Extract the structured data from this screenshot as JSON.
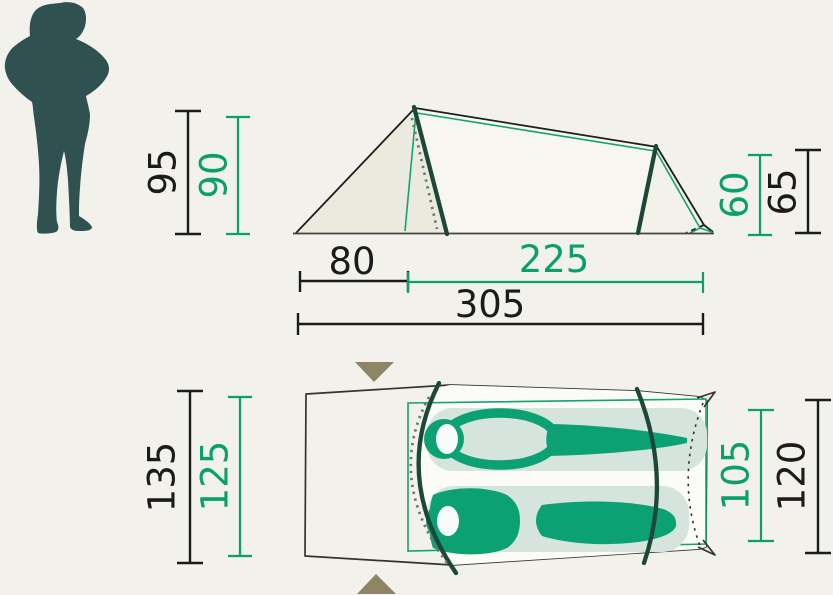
{
  "side_view": {
    "front_height_outer": "95",
    "front_height_inner": "90",
    "rear_height_inner": "60",
    "rear_height_outer": "65",
    "vestibule_length": "80",
    "inner_length": "225",
    "total_length": "305"
  },
  "top_view": {
    "width_outer": "135",
    "width_inner": "125",
    "foot_end_width_inner": "105",
    "foot_end_width_outer": "120"
  },
  "colors": {
    "background": "#f2f1ec",
    "dimension_black": "#1b1b1b",
    "dimension_green": "#0aa06c",
    "pole_dark_green": "#1d4839",
    "silhouette_teal": "#2f5150",
    "arrow_olive": "#8e8565",
    "sleeping_bag_green": "#0ca173",
    "sleeping_pad_light": "#d6e4de",
    "vestibule_beige": "#e9e8de"
  },
  "icons": {
    "human_silhouette": "standing-person-silhouette",
    "entrance_arrow_top": "triangle-down",
    "entrance_arrow_bottom": "triangle-up"
  }
}
